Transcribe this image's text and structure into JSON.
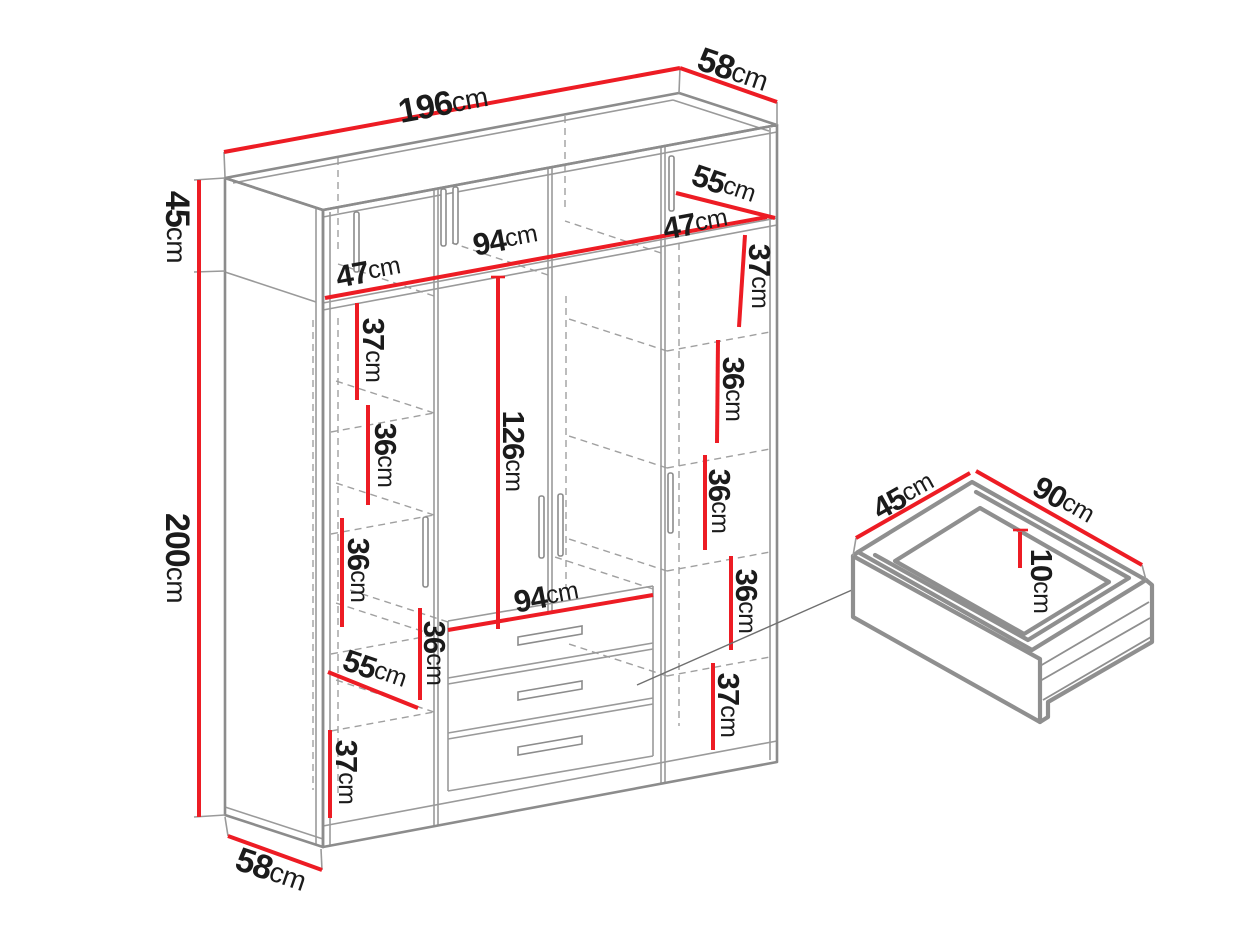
{
  "colors": {
    "dimension_red": "#ed1c24",
    "outline_gray": "#8c8c8c",
    "dash_gray": "#a0a0a0",
    "label_black": "#1b1b1b",
    "background": "#ffffff"
  },
  "wardrobe": {
    "overall": {
      "width": {
        "value": "196",
        "unit": "cm"
      },
      "top_depth": {
        "value": "58",
        "unit": "cm"
      },
      "upper_cabinet_height": {
        "value": "45",
        "unit": "cm"
      },
      "main_height": {
        "value": "200",
        "unit": "cm"
      },
      "bottom_depth": {
        "value": "58",
        "unit": "cm"
      }
    },
    "upper_cabinet": {
      "left_width": {
        "value": "47",
        "unit": "cm"
      },
      "center_width": {
        "value": "94",
        "unit": "cm"
      },
      "right_width": {
        "value": "47",
        "unit": "cm"
      },
      "inner_depth": {
        "value": "55",
        "unit": "cm"
      }
    },
    "left_column": {
      "gap_1": {
        "value": "37",
        "unit": "cm"
      },
      "gap_2": {
        "value": "36",
        "unit": "cm"
      },
      "gap_3": {
        "value": "36",
        "unit": "cm"
      },
      "gap_4": {
        "value": "36",
        "unit": "cm"
      },
      "shelf_depth": {
        "value": "55",
        "unit": "cm"
      },
      "gap_5": {
        "value": "37",
        "unit": "cm"
      }
    },
    "center_column": {
      "hanging_height": {
        "value": "126",
        "unit": "cm"
      },
      "drawer_width": {
        "value": "94",
        "unit": "cm"
      }
    },
    "right_column": {
      "gap_1": {
        "value": "37",
        "unit": "cm"
      },
      "gap_2": {
        "value": "36",
        "unit": "cm"
      },
      "gap_3": {
        "value": "36",
        "unit": "cm"
      },
      "gap_4": {
        "value": "36",
        "unit": "cm"
      },
      "gap_5": {
        "value": "37",
        "unit": "cm"
      }
    }
  },
  "drawer_detail": {
    "depth": {
      "value": "45",
      "unit": "cm"
    },
    "width": {
      "value": "90",
      "unit": "cm"
    },
    "height": {
      "value": "10",
      "unit": "cm"
    }
  }
}
